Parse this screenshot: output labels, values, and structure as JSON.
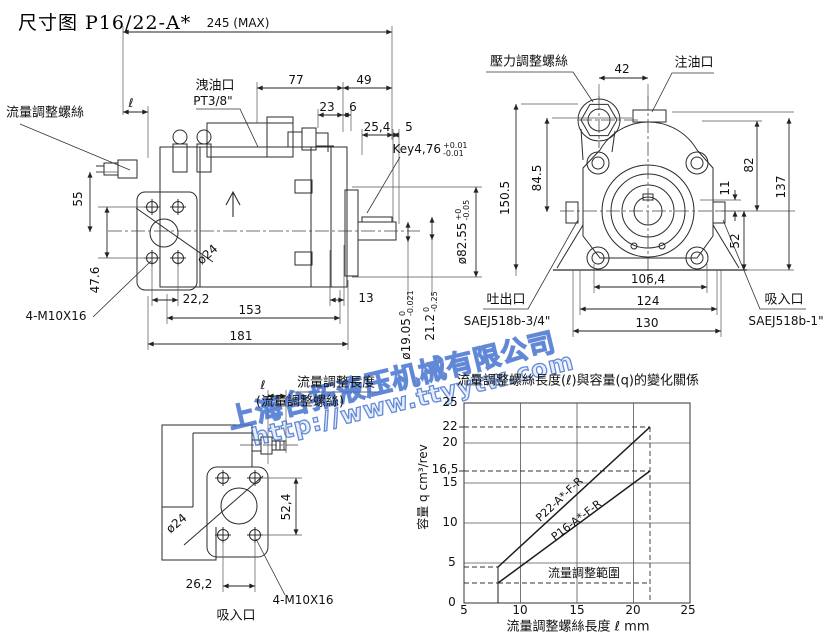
{
  "title": "尺寸图 P16/22-A*",
  "watermark": {
    "line1": "上海台拓液压机械有限公司",
    "line2": "http://www.ttyytw.com",
    "color": "#3f6ecd"
  },
  "side_view": {
    "flow_screw_label": "流量調整螺絲",
    "drain_label": "洩油口",
    "drain_size": "PT3/8\"",
    "bolt_label": "4-M10X16",
    "key": {
      "v": "Key4,76",
      "t": "+0.01",
      "b": "-0.01"
    },
    "dims": {
      "total": "245 (MAX)",
      "d77": "77",
      "d49": "49",
      "d23": "23",
      "d6": "6",
      "d25_4": "25,4",
      "d5": "5",
      "ell": "ℓ",
      "d55": "55",
      "d47_6": "47.6",
      "dia24": "ø24",
      "d22_2": "22,2",
      "d153": "153",
      "d181": "181",
      "d13": "13",
      "dia82": {
        "v": "ø82.55",
        "t": "+0",
        "b": "-0.05"
      },
      "dia19": {
        "v": "ø19.05",
        "t": "0",
        "b": "-0.021"
      },
      "d21_2": {
        "v": "21.2",
        "t": "0",
        "b": "-0.25"
      }
    }
  },
  "front_view": {
    "pressure_screw_label": "壓力調整螺絲",
    "fill_port_label": "注油口",
    "outlet_label": "吐出口",
    "outlet_size": "SAEJ518b-3/4\"",
    "inlet_label": "吸入口",
    "inlet_size": "SAEJ518b-1\"",
    "dims": {
      "d42": "42",
      "d150_5": "150.5",
      "d84_5": "84.5",
      "d82": "82",
      "d137": "137",
      "d11": "11",
      "d52": "52",
      "d106_4": "106,4",
      "d124": "124",
      "d130": "130"
    }
  },
  "top_view": {
    "ell": "ℓ",
    "length_label": "流量調整長度",
    "screw_label": "(流量調整螺絲)",
    "bolt_label": "4-M10X16",
    "inlet_label": "吸入口",
    "dims": {
      "d52_4": "52,4",
      "dia24": "ø24",
      "d26_2": "26,2"
    }
  },
  "chart_data": {
    "type": "line",
    "title": "流量調整螺絲長度(ℓ)與容量(q)的變化關係",
    "xlabel": "流量調整螺絲長度 ℓ mm",
    "ylabel": "容量 q cm³/rev",
    "xlim": [
      5,
      25
    ],
    "ylim": [
      0,
      25
    ],
    "xticks": [
      5,
      10,
      15,
      20,
      25
    ],
    "yticks": [
      0,
      5,
      10,
      15,
      16.5,
      20,
      22,
      25
    ],
    "xtick_labels": [
      "5",
      "10",
      "15",
      "20",
      "25"
    ],
    "ytick_labels": [
      "0",
      "5",
      "10",
      "15",
      "16,5",
      "20",
      "22",
      "25"
    ],
    "grid": true,
    "annotation": "流量調整範圍",
    "series": [
      {
        "name": "P22-A*-F-R",
        "x": [
          8,
          21.5
        ],
        "y": [
          4.5,
          22
        ]
      },
      {
        "name": "P16-A*-F-R",
        "x": [
          8,
          21.5
        ],
        "y": [
          2.5,
          16.5
        ]
      }
    ]
  }
}
